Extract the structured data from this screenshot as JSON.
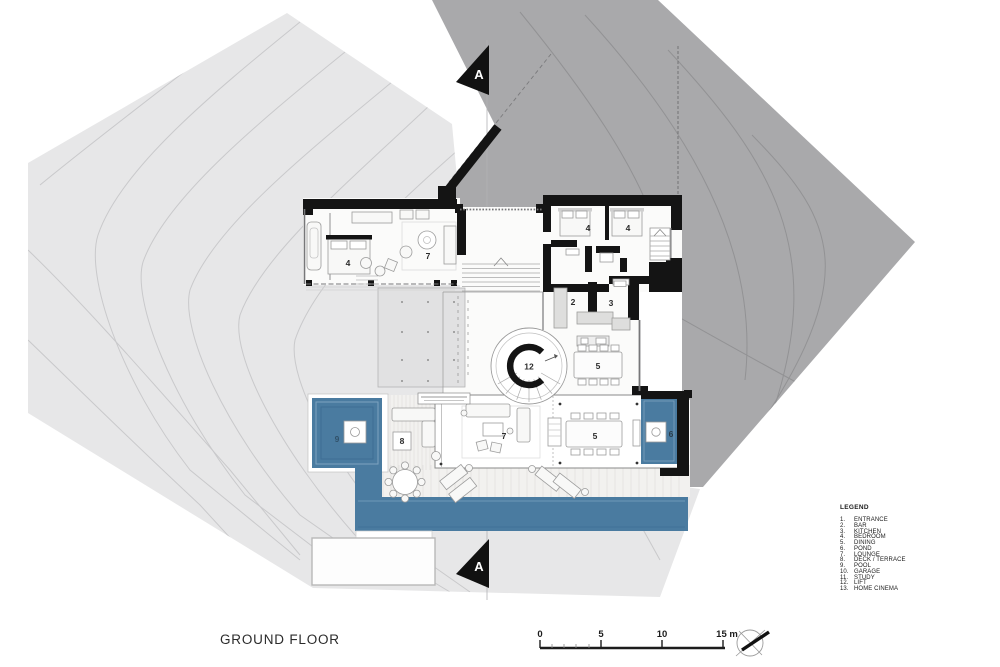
{
  "title": "GROUND FLOOR",
  "section_markers": {
    "top": "A",
    "bottom": "A"
  },
  "scale_bar": {
    "labels": [
      "0",
      "5",
      "10",
      "15 m"
    ]
  },
  "compass": {
    "icon": "north-arrow-icon"
  },
  "legend": {
    "heading": "LEGEND",
    "items": [
      {
        "num": "1.",
        "label": "ENTRANCE"
      },
      {
        "num": "2.",
        "label": "BAR"
      },
      {
        "num": "3.",
        "label": "KITCHEN"
      },
      {
        "num": "4.",
        "label": "BEDROOM"
      },
      {
        "num": "5.",
        "label": "DINING"
      },
      {
        "num": "6.",
        "label": "POND"
      },
      {
        "num": "7.",
        "label": "LOUNGE"
      },
      {
        "num": "8.",
        "label": "DECK / TERRACE"
      },
      {
        "num": "9.",
        "label": "POOL"
      },
      {
        "num": "10.",
        "label": "GARAGE"
      },
      {
        "num": "11.",
        "label": "STUDY"
      },
      {
        "num": "12.",
        "label": "LIFT"
      },
      {
        "num": "13.",
        "label": "HOME CINEMA"
      }
    ]
  },
  "plan": {
    "room_labels": [
      {
        "num": "4",
        "room": "bedroom"
      },
      {
        "num": "7",
        "room": "lounge"
      },
      {
        "num": "4",
        "room": "bedroom"
      },
      {
        "num": "4",
        "room": "bedroom"
      },
      {
        "num": "2",
        "room": "bar"
      },
      {
        "num": "3",
        "room": "kitchen"
      },
      {
        "num": "12",
        "room": "lift"
      },
      {
        "num": "5",
        "room": "dining"
      },
      {
        "num": "5",
        "room": "dining"
      },
      {
        "num": "7",
        "room": "lounge"
      },
      {
        "num": "8",
        "room": "deck-terrace"
      },
      {
        "num": "9",
        "room": "pool"
      },
      {
        "num": "6",
        "room": "pond"
      }
    ]
  },
  "colors": {
    "water": "#4a7ba0",
    "terrain_light": "#e7e7e8",
    "terrain_dark": "#a9a9ab",
    "wall": "#141414"
  }
}
